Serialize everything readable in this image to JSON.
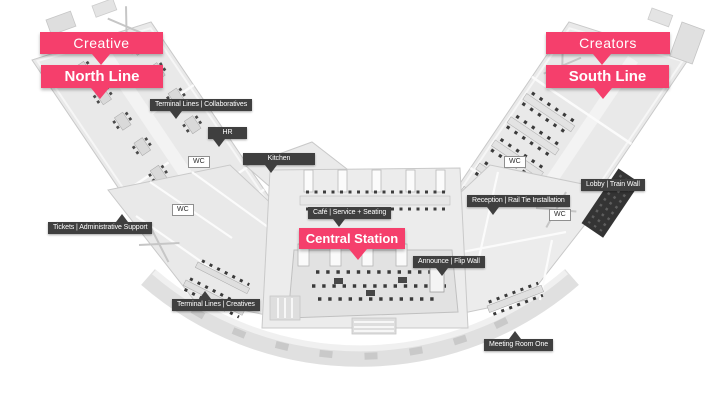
{
  "zones": {
    "north": {
      "area_label": "Creative",
      "line_label": "North Line"
    },
    "south": {
      "area_label": "Creators",
      "line_label": "South Line"
    },
    "center": {
      "station_label": "Central Station"
    }
  },
  "rooms": [
    {
      "id": "terminal-collaboratives",
      "label": "Terminal Lines | Collaboratives"
    },
    {
      "id": "hr",
      "label": "HR"
    },
    {
      "id": "kitchen",
      "label": "Kitchen"
    },
    {
      "id": "cafe",
      "label": "Café | Service + Seating"
    },
    {
      "id": "tickets",
      "label": "Tickets | Administrative Support"
    },
    {
      "id": "terminal-creatives",
      "label": "Terminal Lines | Creatives"
    },
    {
      "id": "reception",
      "label": "Reception | Rail Tie Installation"
    },
    {
      "id": "lobby",
      "label": "Lobby | Train Wall"
    },
    {
      "id": "announce",
      "label": "Announce | Flip Wall"
    },
    {
      "id": "meeting-room-one",
      "label": "Meeting Room One"
    }
  ],
  "wc_tags": [
    {
      "label": "WC"
    },
    {
      "label": "WC"
    },
    {
      "label": "WC"
    },
    {
      "label": "WC"
    }
  ],
  "colors": {
    "accent_pink": "#f53f6c",
    "label_dark": "#3f3f3f",
    "floor_gray": "#e9e9e9",
    "wall_gray": "#c9c9c9",
    "background": "#ffffff"
  }
}
